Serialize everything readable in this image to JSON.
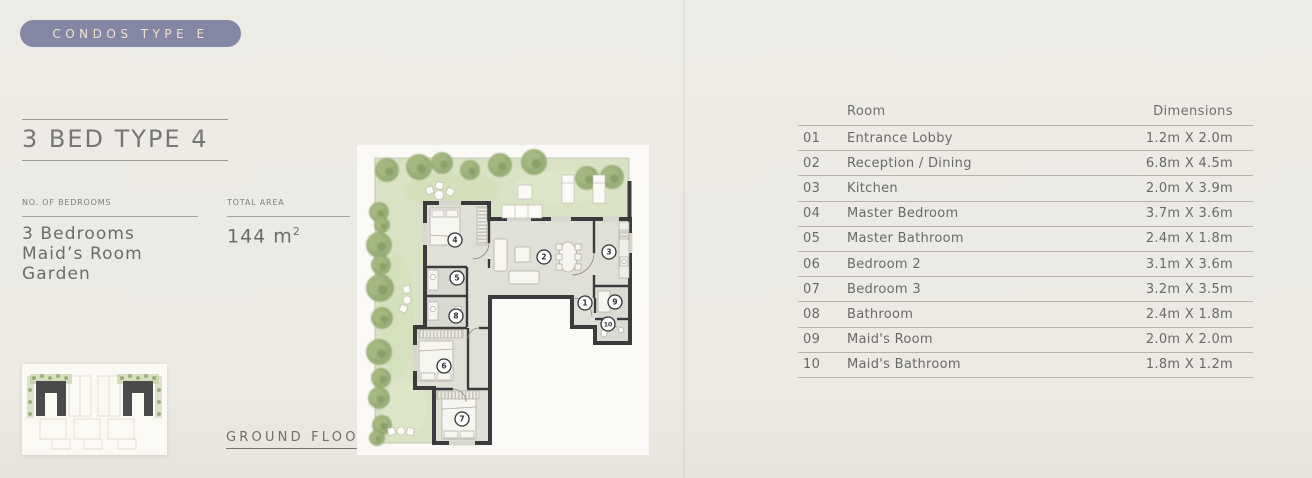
{
  "badge": {
    "label": "CONDOS TYPE E"
  },
  "header": {
    "title": "3 BED TYPE 4"
  },
  "specs": {
    "bedrooms_label": "NO. OF BEDROOMS",
    "bedrooms_value_lines": [
      "3  Bedrooms",
      "Maid’s Room",
      "Garden"
    ],
    "area_label": "TOTAL AREA",
    "area_value": "144 m",
    "area_superscript": "2"
  },
  "floor_plan": {
    "caption": "GROUND FLOOR",
    "room_markers": [
      {
        "num": "1",
        "x": 228,
        "y": 158
      },
      {
        "num": "2",
        "x": 187,
        "y": 112
      },
      {
        "num": "3",
        "x": 252,
        "y": 107
      },
      {
        "num": "4",
        "x": 98,
        "y": 95
      },
      {
        "num": "5",
        "x": 100,
        "y": 133
      },
      {
        "num": "6",
        "x": 87,
        "y": 221
      },
      {
        "num": "7",
        "x": 105,
        "y": 274
      },
      {
        "num": "8",
        "x": 99,
        "y": 171
      },
      {
        "num": "9",
        "x": 258,
        "y": 157
      },
      {
        "num": "10",
        "x": 251,
        "y": 179
      }
    ]
  },
  "rooms_table": {
    "columns": {
      "room": "Room",
      "dimensions": "Dimensions"
    },
    "rows": [
      {
        "no": "01",
        "room": "Entrance Lobby",
        "dimensions": "1.2m X 2.0m"
      },
      {
        "no": "02",
        "room": "Reception / Dining",
        "dimensions": "6.8m X 4.5m"
      },
      {
        "no": "03",
        "room": "Kitchen",
        "dimensions": "2.0m X 3.9m"
      },
      {
        "no": "04",
        "room": "Master Bedroom",
        "dimensions": "3.7m X 3.6m"
      },
      {
        "no": "05",
        "room": "Master Bathroom",
        "dimensions": "2.4m X 1.8m"
      },
      {
        "no": "06",
        "room": "Bedroom 2",
        "dimensions": "3.1m X 3.6m"
      },
      {
        "no": "07",
        "room": "Bedroom 3",
        "dimensions": "3.2m X 3.5m"
      },
      {
        "no": "08",
        "room": "Bathroom",
        "dimensions": "2.4m X 1.8m"
      },
      {
        "no": "09",
        "room": "Maid's Room",
        "dimensions": "2.0m X 2.0m"
      },
      {
        "no": "10",
        "room": "Maid's Bathroom",
        "dimensions": "1.8m X 1.2m"
      }
    ]
  },
  "colors": {
    "background": "#ECEAE4",
    "badge_bg": "#8487A3",
    "badge_text": "#EFE2D0",
    "wall": "#3B3B3D",
    "floor": "#E1E0D7",
    "garden": "#D9E2C5",
    "tree": "#8FA76D",
    "separator": "#B5B2AB"
  }
}
